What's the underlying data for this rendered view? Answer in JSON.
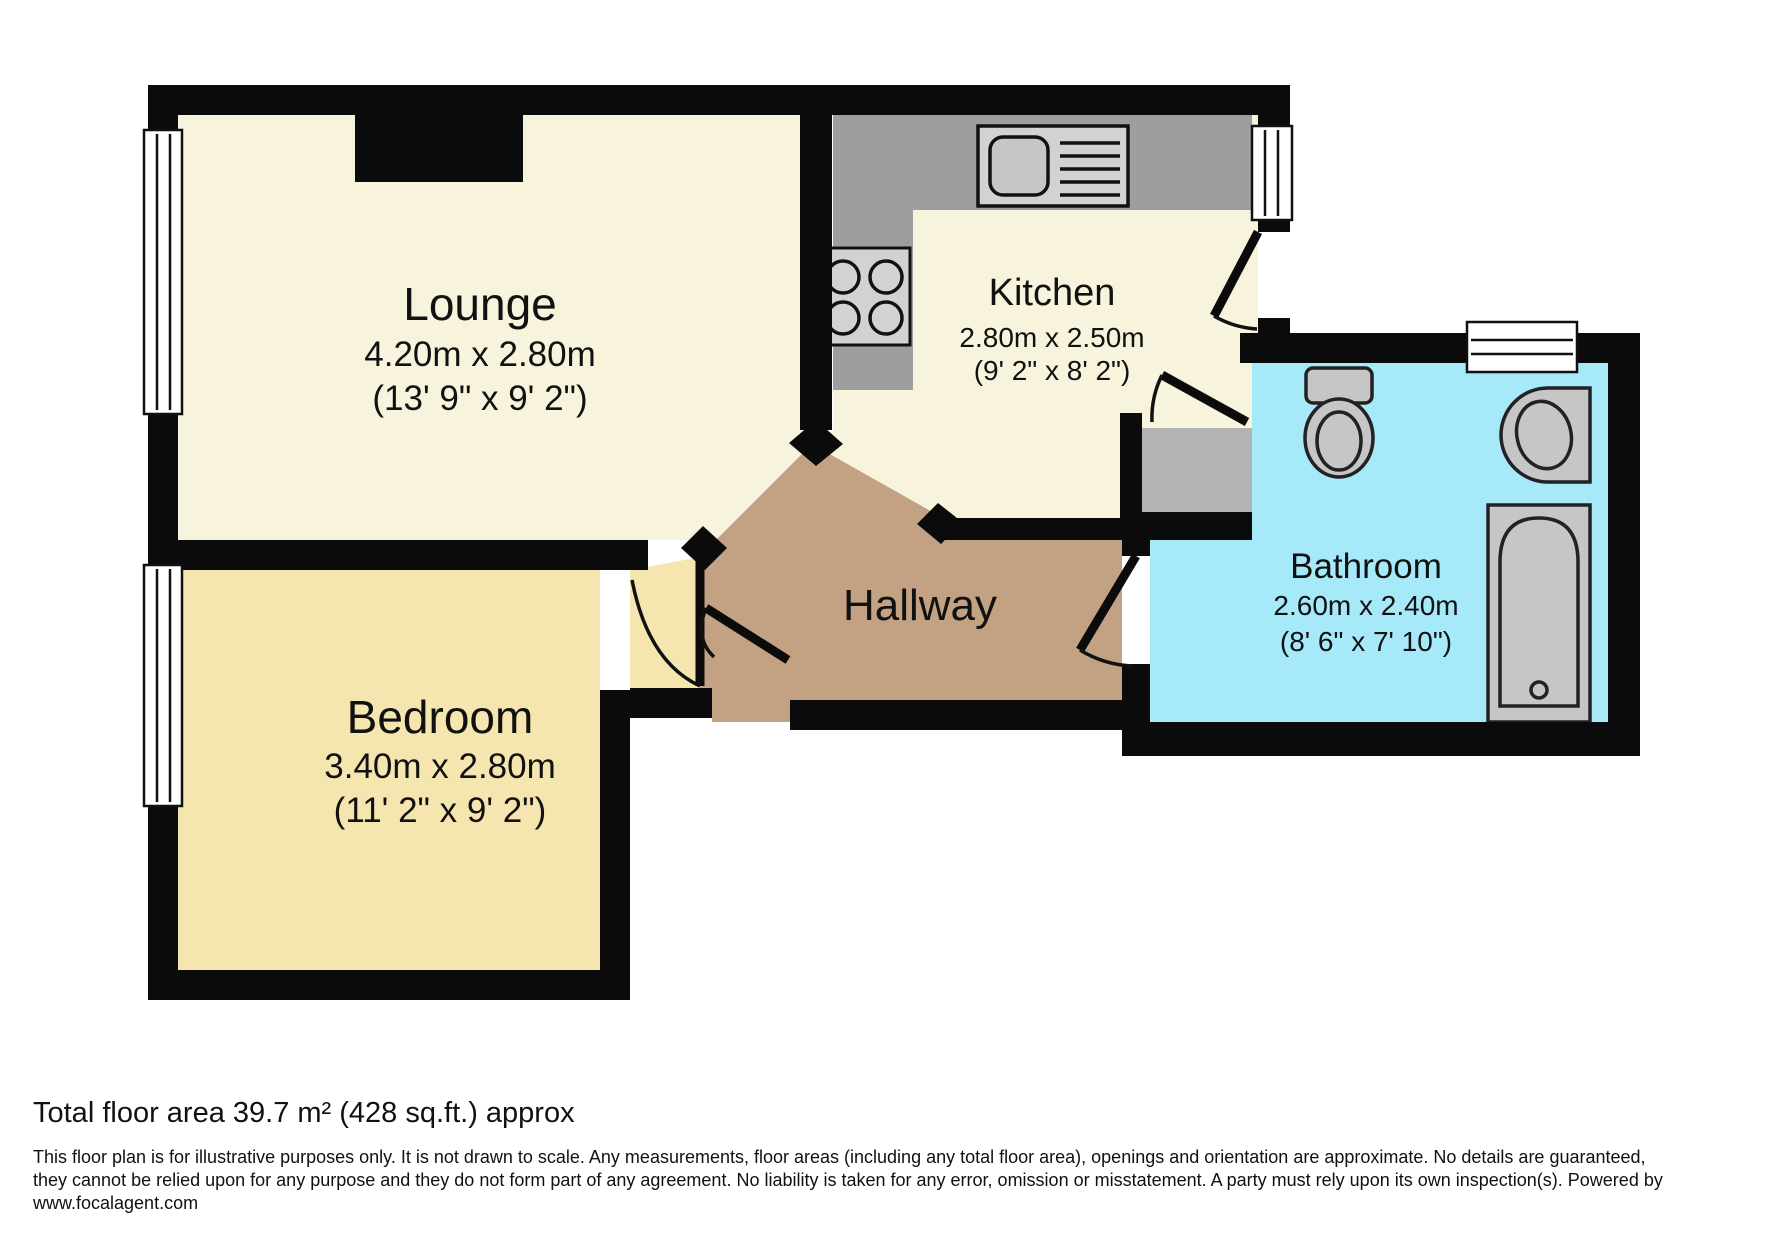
{
  "rooms": {
    "lounge": {
      "name": "Lounge",
      "metric": "4.20m x 2.80m",
      "imperial": "(13' 9\" x 9' 2\")"
    },
    "kitchen": {
      "name": "Kitchen",
      "metric": "2.80m x 2.50m",
      "imperial": "(9' 2\" x 8' 2\")"
    },
    "bedroom": {
      "name": "Bedroom",
      "metric": "3.40m x 2.80m",
      "imperial": "(11' 2\" x 9' 2\")"
    },
    "bathroom": {
      "name": "Bathroom",
      "metric": "2.60m x 2.40m",
      "imperial": "(8' 6\" x 7' 10\")"
    },
    "hallway": {
      "name": "Hallway"
    }
  },
  "footer": {
    "total_area": "Total floor area 39.7 m² (428 sq.ft.) approx",
    "disclaimer_1": "This floor plan is for illustrative purposes only. It is not drawn to scale. Any measurements, floor areas (including any total floor area), openings and orientation are approximate. No details are guaranteed,",
    "disclaimer_2": "they cannot be relied upon for any purpose and they do not form part of any agreement. No liability is taken for any error, omission or misstatement. A party must rely upon its own inspection(s). Powered by",
    "disclaimer_3": "www.focalagent.com"
  },
  "colors": {
    "wall": "#0b0b0b",
    "lounge": "#f8f3dc",
    "kitchen": "#f8f3dc",
    "bedroom": "#f5e6b0",
    "hallway": "#c3a284",
    "bathroom": "#a6e9f8",
    "counter": "#9e9e9e",
    "fixture": "#c6c6c6",
    "fixture_light": "#d2d2d2",
    "storage": "#b3b3b3",
    "window": "#ffffff"
  }
}
